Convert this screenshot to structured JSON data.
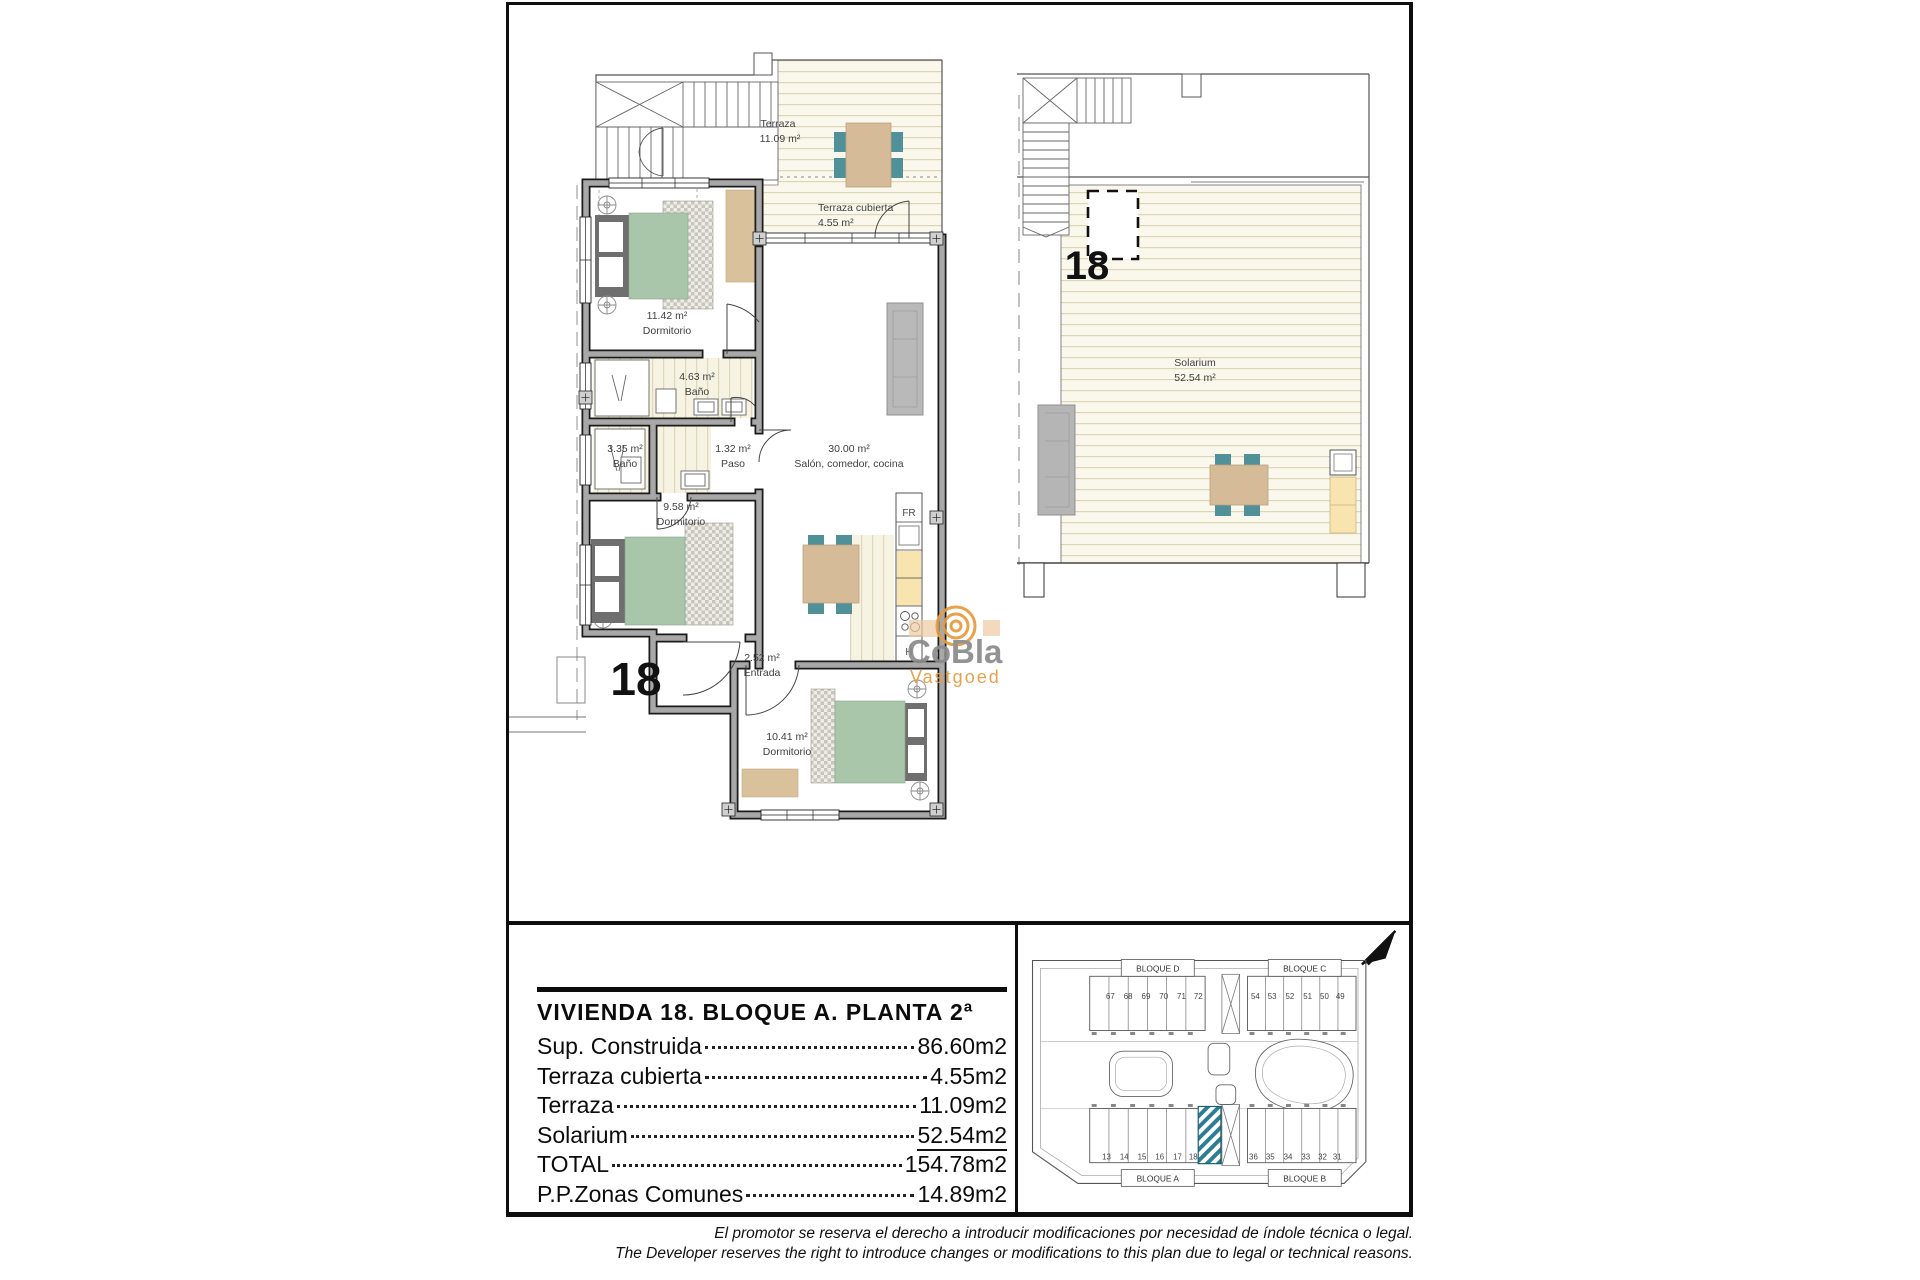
{
  "plan_main": {
    "unit_number": "18",
    "terrace": {
      "name": "Terraza",
      "area": "11.09 m²"
    },
    "covered_terrace": {
      "name": "Terraza cubierta",
      "area": "4.55 m²"
    },
    "bedroom1": {
      "area": "11.42 m²",
      "name": "Dormitorio"
    },
    "bath1": {
      "area": "4.63 m²",
      "name": "Baño"
    },
    "bath2": {
      "area": "3.35 m²",
      "name": "Baño"
    },
    "hall": {
      "area": "1.32 m²",
      "name": "Paso"
    },
    "bedroom2": {
      "area": "9.58 m²",
      "name": "Dormitorio"
    },
    "living": {
      "area": "30.00 m²",
      "name": "Salón, comedor, cocina"
    },
    "entry": {
      "area": "2.52 m²",
      "name": "Entrada"
    },
    "bedroom3": {
      "area": "10.41 m²",
      "name": "Dormitorio"
    },
    "fridge_label": "FR",
    "hob_label": "H",
    "stair_label": "T"
  },
  "plan_solarium": {
    "unit_number": "18",
    "solarium": {
      "name": "Solarium",
      "area": "52.54 m²"
    }
  },
  "watermark": {
    "line1": "CoBla",
    "line2": "Vastgoed",
    "accent": "#e89a3c",
    "gray": "#8a8a8a"
  },
  "legend": {
    "title": "VIVIENDA 18. BLOQUE A. PLANTA 2ª",
    "rows": [
      {
        "label": "Sup. Construida",
        "value": "86.60m2"
      },
      {
        "label": "Terraza cubierta",
        "value": "4.55m2"
      },
      {
        "label": "Terraza",
        "value": "11.09m2"
      },
      {
        "label": "Solarium",
        "value": "52.54m2"
      },
      {
        "label": "TOTAL",
        "value": "154.78m2"
      },
      {
        "label": "P.P.Zonas Comunes",
        "value": "14.89m2"
      }
    ]
  },
  "site": {
    "highlighted_unit": "18",
    "highlight_color": "#2e7d95",
    "blocks": [
      {
        "label": "BLOQUE D",
        "units": [
          "67",
          "68",
          "69",
          "70",
          "71",
          "72"
        ]
      },
      {
        "label": "BLOQUE C",
        "units": [
          "54",
          "53",
          "52",
          "51",
          "50",
          "49"
        ]
      },
      {
        "label": "BLOQUE A",
        "units": [
          "13",
          "14",
          "15",
          "16",
          "17",
          "18"
        ]
      },
      {
        "label": "BLOQUE B",
        "units": [
          "36",
          "35",
          "34",
          "33",
          "32",
          "31"
        ]
      }
    ]
  },
  "disclaimer": {
    "line1": "El promotor se reserva el derecho a introducir modificaciones por necesidad de índole técnica o legal.",
    "line2": "The Developer reserves the right to introduce changes or modifications to this plan due to legal or technical reasons."
  }
}
